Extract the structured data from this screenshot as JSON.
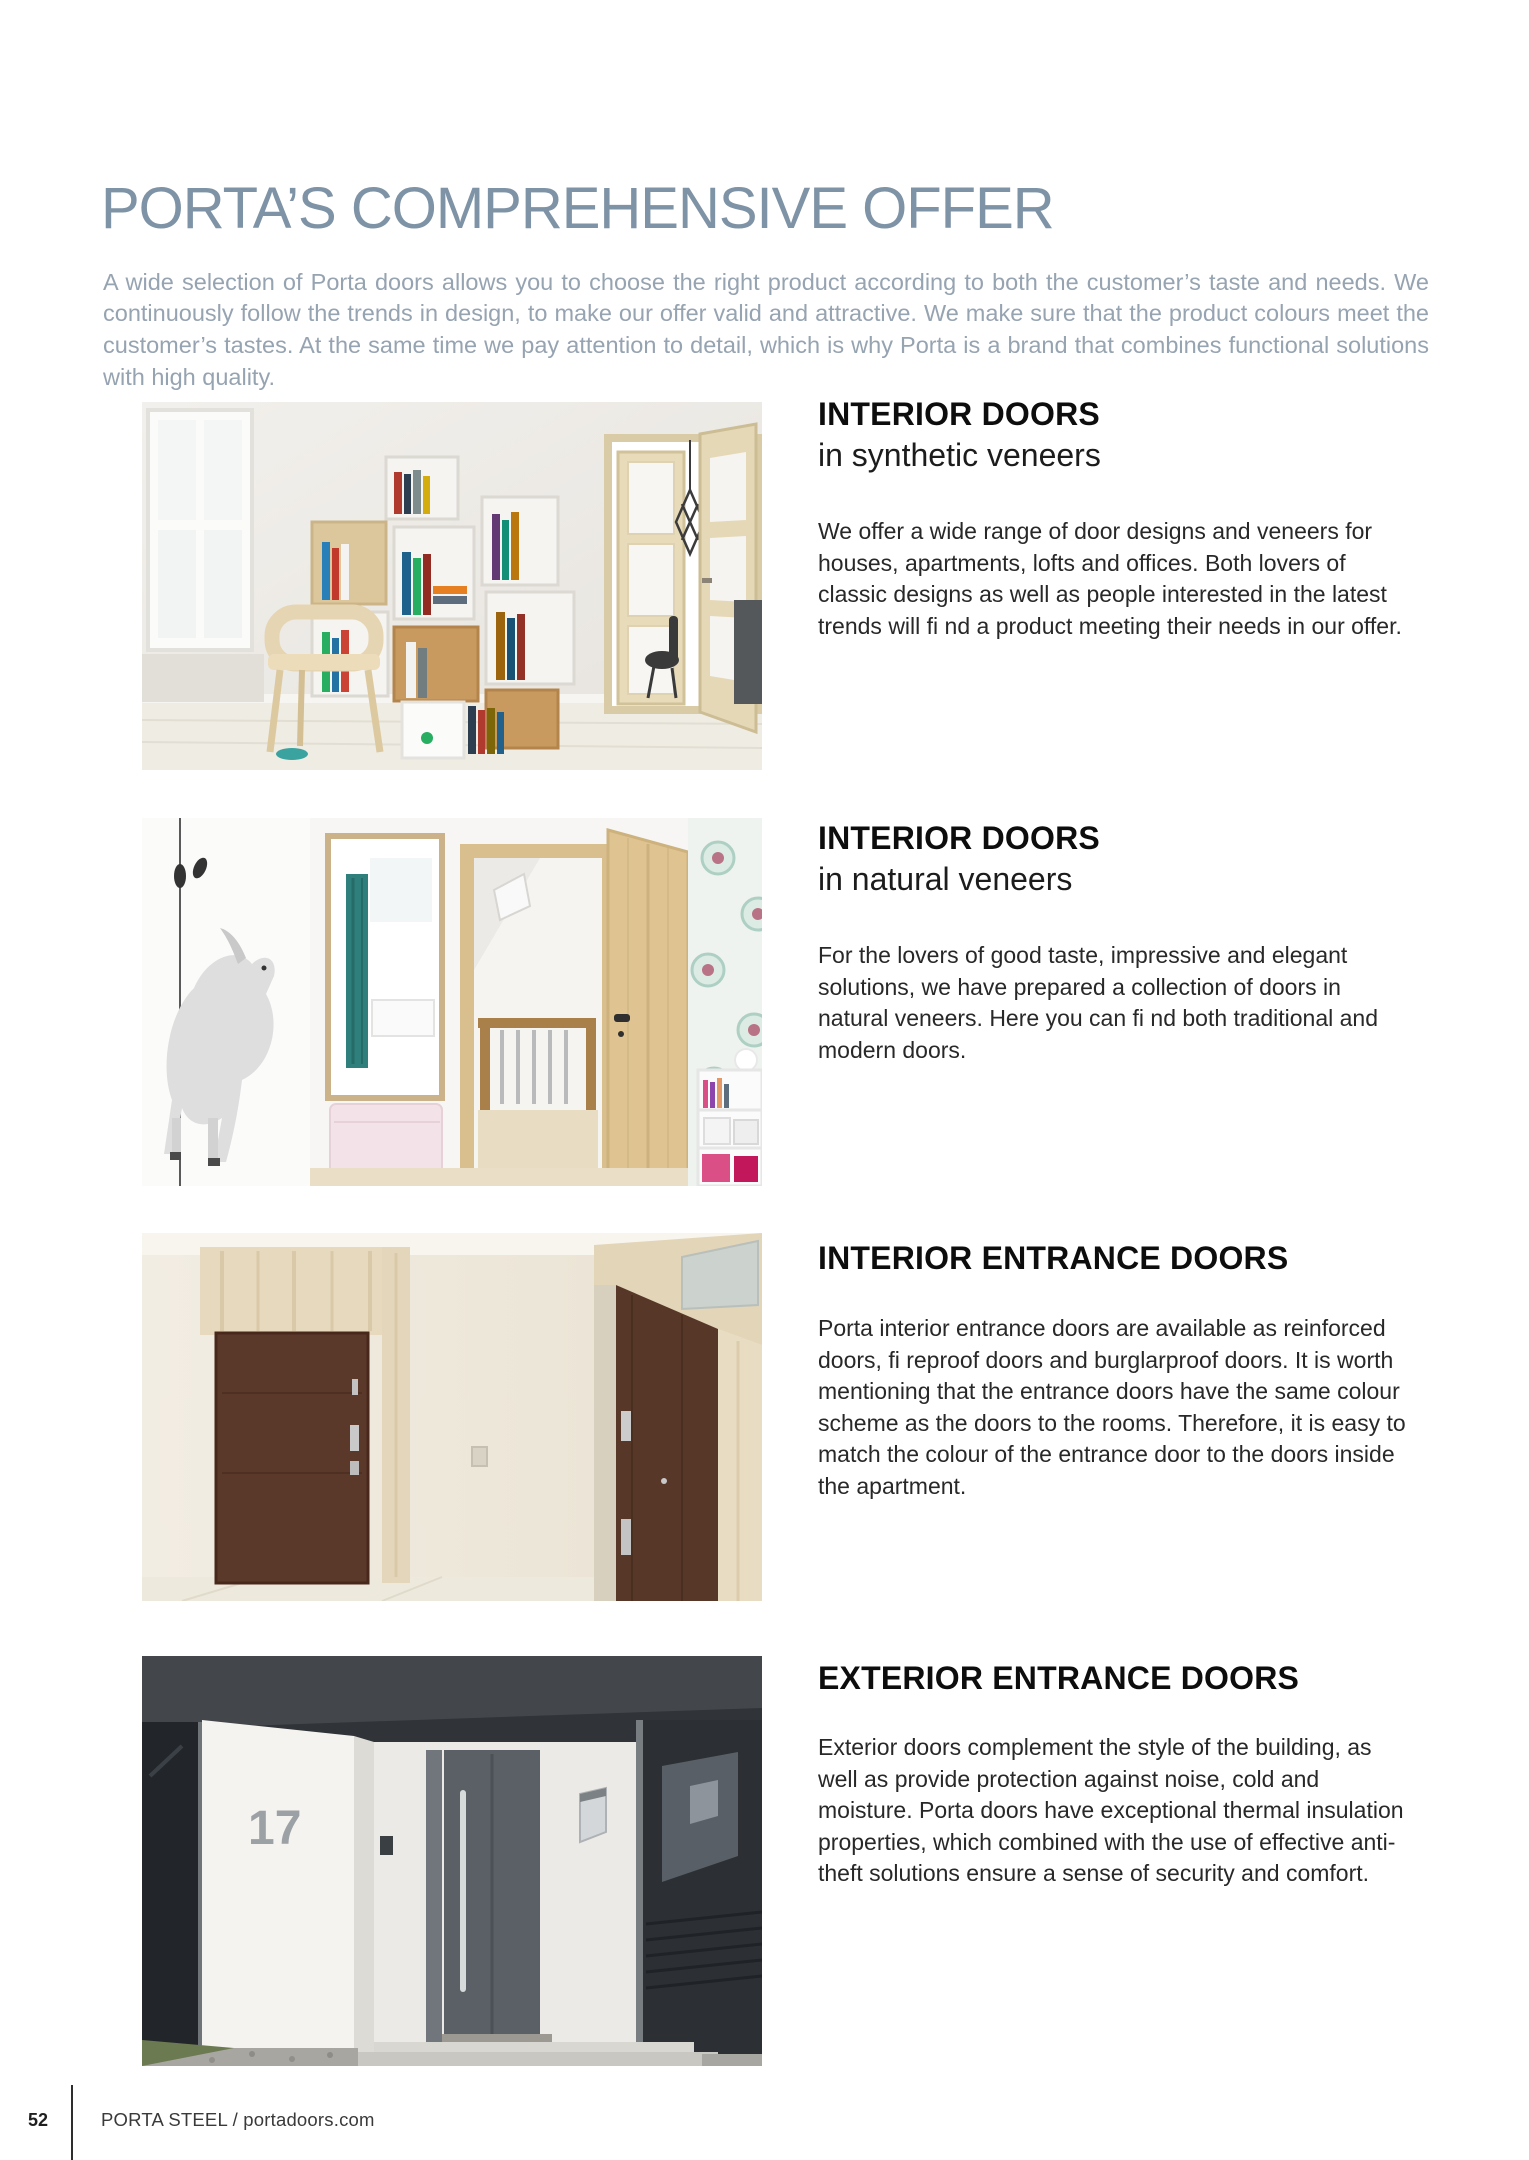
{
  "page": {
    "title": "PORTA’S COMPREHENSIVE OFFER",
    "intro": "A wide selection of Porta doors allows you to choose the right product according to both the customer’s taste and needs. We continuously follow the trends in design, to make our offer valid and attractive. We make sure that the product colours meet the customer’s tastes. At the same time we pay attention to detail, which is why Porta is a brand that combines functional solutions with high quality."
  },
  "sections": [
    {
      "title": "INTERIOR DOORS",
      "subtitle": "in synthetic veneers",
      "body": "We offer a wide range of door designs and veneers for houses, apartments, lofts and offices. Both lovers of classic designs as well as people interested in the latest trends will fi nd a product meeting their needs in our offer.",
      "photo": "interior room with cube bookshelf, wooden chair and light oak double doors with frosted panels"
    },
    {
      "title": "INTERIOR DOORS",
      "subtitle": "in natural veneers",
      "body": "For the lovers of good taste, impressive and elegant solutions, we have prepared a collection of doors in natural veneers. Here you can fi nd both traditional and modern doors.",
      "photo": "child room with horse mural, mirror, open natural oak door to staircase and floral wallpaper"
    },
    {
      "title": "INTERIOR ENTRANCE DOORS",
      "subtitle": "",
      "body": "Porta interior entrance doors are available as reinforced doors, fi reproof doors and burglarproof doors. It is worth mentioning that the entrance doors have the same colour scheme as the doors to the rooms. Therefore, it is easy to match the colour of the entrance door to the doors inside the apartment.",
      "photo": "hallway with two dark brown entrance doors framed in travertine stone"
    },
    {
      "title": "EXTERIOR ENTRANCE DOORS",
      "subtitle": "",
      "body": "Exterior doors complement the style of the building, as well as provide protection against noise, cold and moisture. Porta doors have exceptional thermal insulation properties, which combined with the use of effective anti-theft solutions ensure a sense of security and comfort.",
      "photo": "modern house entrance with anthracite door, vertical steel handle and house number",
      "house_number": "17"
    }
  ],
  "footer": {
    "page_number": "52",
    "text": "PORTA STEEL / portadoors.com"
  },
  "colors": {
    "title": "#7e93a6",
    "intro_text": "#96a3b1",
    "heading_text": "#0d0d0d",
    "body_text": "#282828",
    "dark_door": "#5a392a",
    "anthracite_door": "#5a6065"
  }
}
